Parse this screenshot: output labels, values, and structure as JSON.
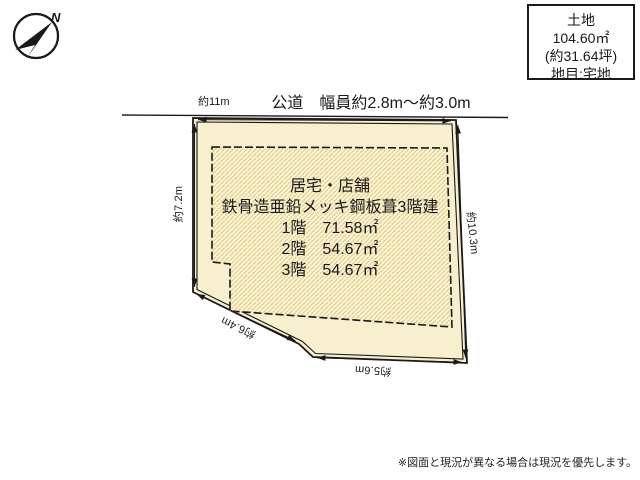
{
  "diagram": {
    "compass": {
      "north_label": "N"
    },
    "land_info": {
      "lines": [
        "土地",
        "104.60㎡",
        "(約31.64坪)",
        "地目:宅地"
      ]
    },
    "road": {
      "label": "公道　幅員約2.8m～約3.0m",
      "frontage_label": "約11m"
    },
    "lot": {
      "dim_left": "約7.2m",
      "dim_right": "約10.3m",
      "dim_slope": "約6.4m",
      "dim_bottom": "約5.6m"
    },
    "building": {
      "lines": [
        "居宅・店舗",
        "鉄骨造亜鉛メッキ鋼板葺3階建",
        "1階　71.58㎡",
        "2階　54.67㎡",
        "3階　54.67㎡"
      ]
    },
    "disclaimer": "※図面と現況が異なる場合は現況を優先します。",
    "colors": {
      "lot_fill": "#f8efcf",
      "hatch_bg": "#fbf4db",
      "hatch_stripe": "#e3cf83",
      "line": "#1a1a1a"
    }
  }
}
